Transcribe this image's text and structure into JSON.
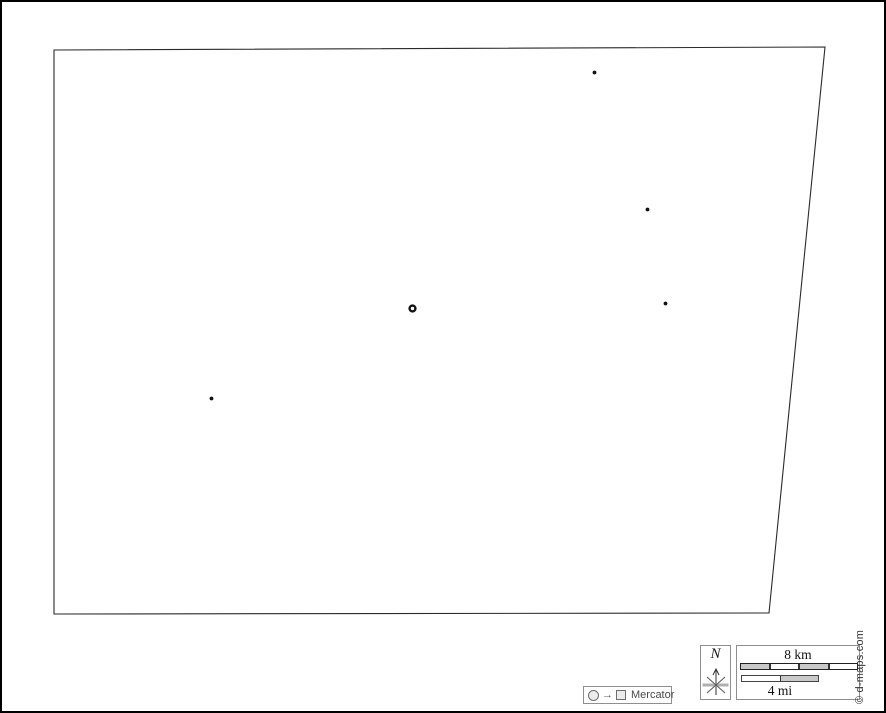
{
  "map": {
    "boundary_points": [
      [
        52,
        48
      ],
      [
        823,
        45
      ],
      [
        767,
        611
      ],
      [
        52,
        612
      ]
    ],
    "stroke_color": "#2a2a2a",
    "stroke_width": 1.1,
    "markers": [
      {
        "type": "town",
        "x": 592.5,
        "y": 70.5,
        "r": 1.9
      },
      {
        "type": "town",
        "x": 645.5,
        "y": 207.5,
        "r": 1.9
      },
      {
        "type": "town",
        "x": 663.5,
        "y": 301.5,
        "r": 1.9
      },
      {
        "type": "town",
        "x": 209.5,
        "y": 396.5,
        "r": 1.9
      },
      {
        "type": "capital",
        "x": 410.5,
        "y": 306.5,
        "outer_r": 4.1,
        "inner_r": 1.7
      }
    ],
    "marker_color": "#111111"
  },
  "legend": {
    "circle_icon": "circle-symbol",
    "arrow": "→",
    "square_icon": "square-symbol",
    "projection": "Mercator"
  },
  "compass": {
    "north_label": "N"
  },
  "scalebar": {
    "km_label": "8 km",
    "mi_label": "4 mi",
    "km_segments": [
      "#c9c9c9",
      "#ffffff",
      "#c9c9c9",
      "#ffffff"
    ],
    "mi_segments": [
      "#ffffff",
      "#c9c9c9"
    ]
  },
  "credit": {
    "text": "© d-maps.com"
  },
  "colors": {
    "box_border": "#8f8f8f",
    "bar_gray": "#c9c9c9",
    "ink": "#1a1a1a",
    "gray_text": "#4a4a4a"
  }
}
